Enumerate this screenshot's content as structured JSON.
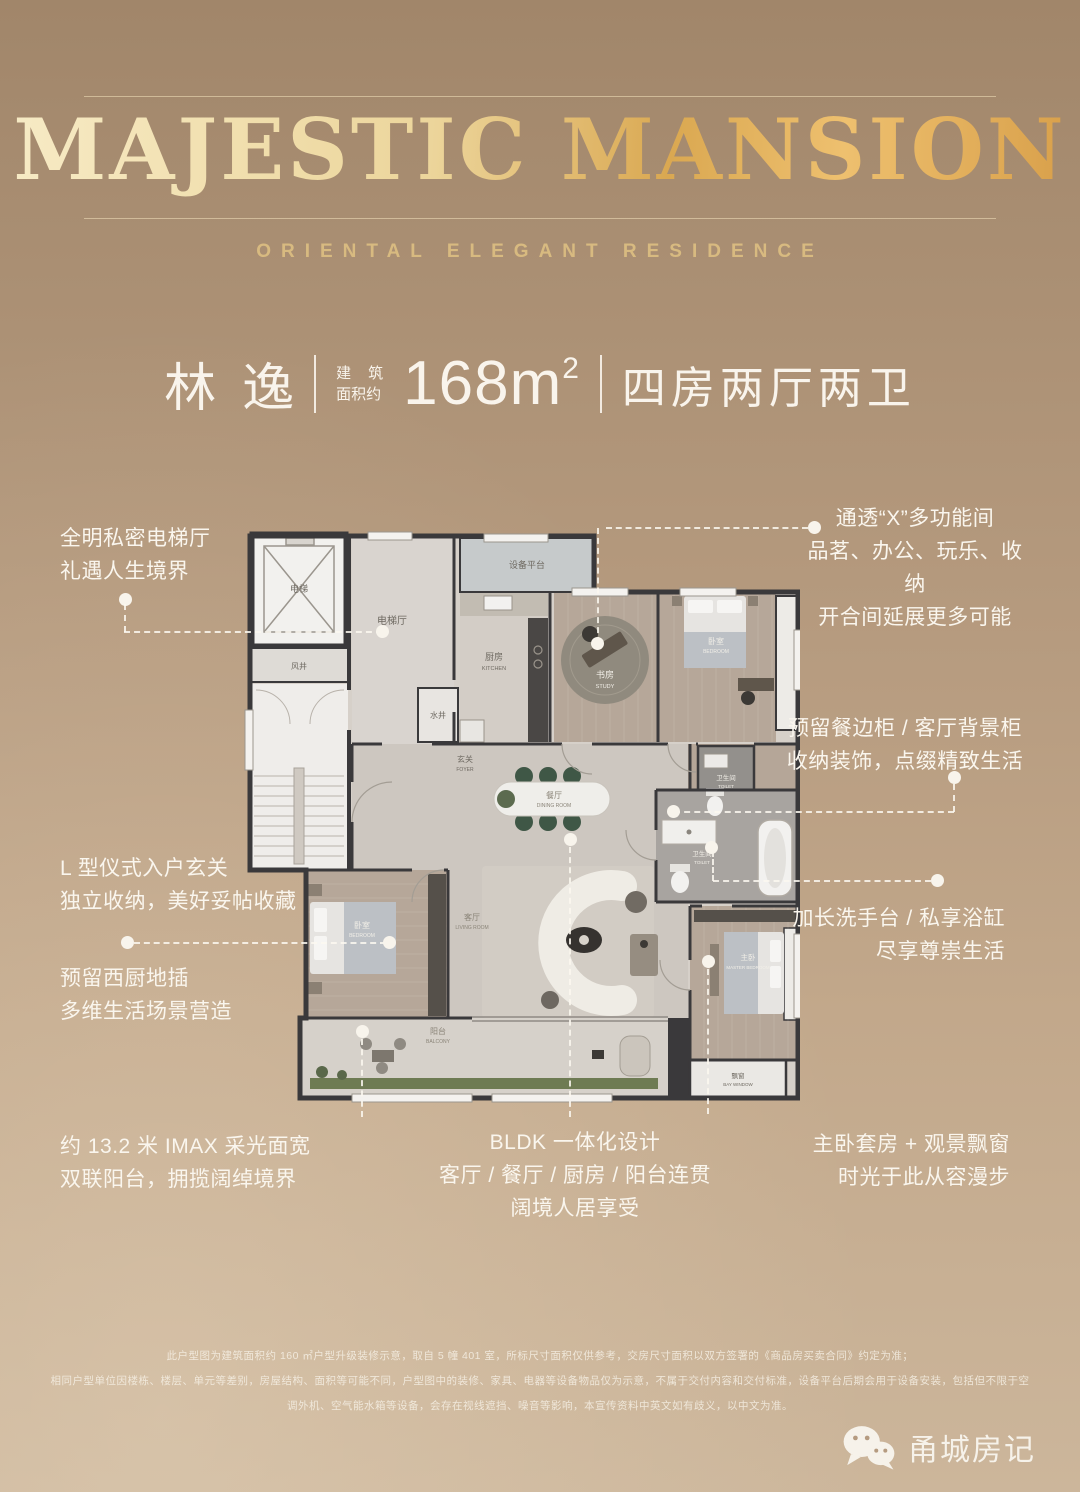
{
  "header": {
    "title": "MAJESTIC MANSION",
    "subtitle": "ORIENTAL ELEGANT RESIDENCE"
  },
  "headline": {
    "name": "林逸",
    "area_label_line1": "建筑",
    "area_label_line2": "面积约",
    "area_value": "168m",
    "area_superscript": "2",
    "rooms_summary": "四房两厅两卫"
  },
  "floorplan": {
    "rooms": {
      "elevator": {
        "cn": "电梯"
      },
      "air_shaft": {
        "cn": "风井"
      },
      "elevator_hall": {
        "cn": "电梯厅"
      },
      "equipment_platform": {
        "cn": "设备平台"
      },
      "kitchen": {
        "cn": "厨房",
        "en": "KITCHEN"
      },
      "water_shaft": {
        "cn": "水井"
      },
      "study": {
        "cn": "书房",
        "en": "STUDY"
      },
      "bedroom_north": {
        "cn": "卧室",
        "en": "BEDROOM"
      },
      "foyer": {
        "cn": "玄关",
        "en": "FOYER"
      },
      "dining": {
        "cn": "餐厅",
        "en": "DINING ROOM"
      },
      "toilet": {
        "cn": "卫生间",
        "en": "TOILET"
      },
      "master_bath": {
        "cn": "卫生间",
        "en": "TOILET"
      },
      "bedroom_west": {
        "cn": "卧室",
        "en": "BEDROOM"
      },
      "living": {
        "cn": "客厅",
        "en": "LIVING ROOM"
      },
      "master_bedroom": {
        "cn": "主卧",
        "en": "MASTER BEDROOM"
      },
      "balcony": {
        "cn": "阳台",
        "en": "BALCONY"
      },
      "bay_window": {
        "cn": "飘窗",
        "en": "BAY WINDOW"
      }
    }
  },
  "callouts": {
    "elevator_hall": {
      "line1": "全明私密电梯厅",
      "line2": "礼遇人生境界"
    },
    "multifunction": {
      "line1": "通透“X”多功能间",
      "line2": "品茗、办公、玩乐、收纳",
      "line3": "开合间延展更多可能"
    },
    "sideboard": {
      "line1": "预留餐边柜 / 客厅背景柜",
      "line2": "收纳装饰，点缀精致生活"
    },
    "foyer": {
      "line1": "L 型仪式入户玄关",
      "line2": "独立收纳，美好妥帖收藏"
    },
    "west_kitchen": {
      "line1": "预留西厨地插",
      "line2": "多维生活场景营造"
    },
    "bathroom": {
      "line1": "加长洗手台 / 私享浴缸",
      "line2": "尽享尊崇生活"
    },
    "balcony": {
      "line1": "约 13.2 米 IMAX 采光面宽",
      "line2": "双联阳台，拥揽阔绰境界"
    },
    "bldk": {
      "line1": "BLDK 一体化设计",
      "line2": "客厅 / 餐厅 / 厨房 / 阳台连贯",
      "line3": "阔境人居享受"
    },
    "master_suite": {
      "line1": "主卧套房 + 观景飘窗",
      "line2": "时光于此从容漫步"
    }
  },
  "disclaimer": {
    "line1": "此户型图为建筑面积约 160 ㎡户型升级装修示意，取自 5 幢 401 室，所标尺寸面积仅供参考，交房尺寸面积以双方签署的《商品房买卖合同》约定为准；",
    "line2": "相同户型单位因楼栋、楼层、单元等差别，房屋结构、面积等可能不同，户型图中的装修、家具、电器等设备物品仅为示意，不属于交付内容和交付标准，设备平台后期会用于设备安装，包括但不限于空",
    "line3": "调外机、空气能水箱等设备，会存在视线遮挡、噪音等影响，本宣传资料中英文如有歧义，以中文为准。"
  },
  "watermark": {
    "label": "甬城房记",
    "icon": "wechat-icon"
  },
  "colors": {
    "gold_light": "#f7ebc6",
    "gold_deep": "#d79e48",
    "background_top": "#a1866a",
    "background_bottom": "#ccb69b",
    "text": "#f9f4ec",
    "wall": "#3a393b",
    "wood_floor": "#b6a799",
    "marble_floor": "#cdc7c0",
    "chair_green": "#3f5746",
    "planter_green": "#6e7b53"
  }
}
